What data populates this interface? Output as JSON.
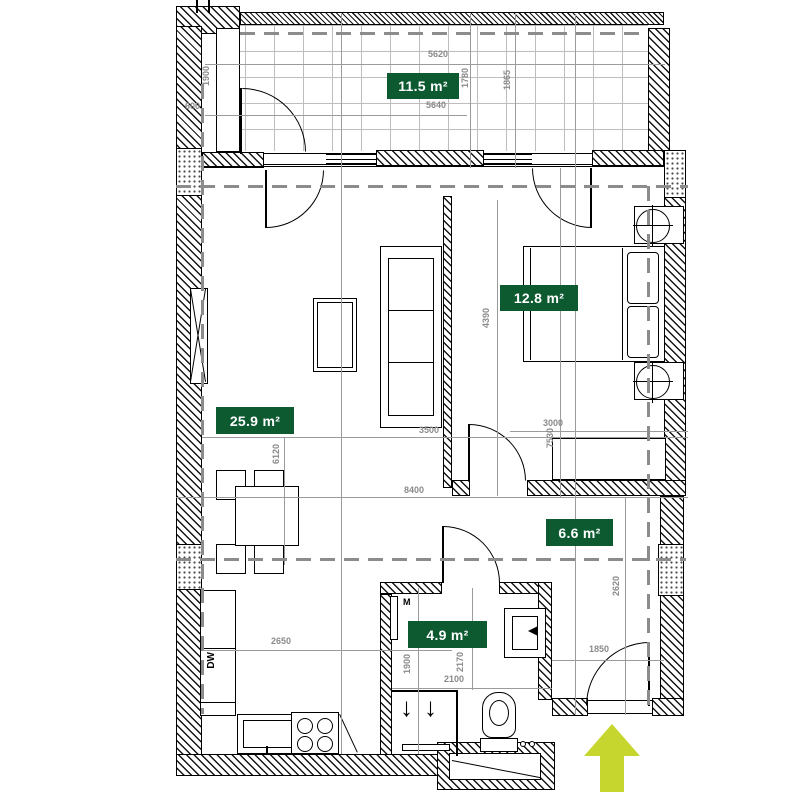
{
  "plan": {
    "rooms": [
      {
        "id": "balcony",
        "area_label": "11.5 m²"
      },
      {
        "id": "living_room",
        "area_label": "25.9 m²"
      },
      {
        "id": "bedroom",
        "area_label": "12.8 m²"
      },
      {
        "id": "hallway",
        "area_label": "6.6 m²"
      },
      {
        "id": "bathroom",
        "area_label": "4.9 m²"
      }
    ],
    "dimensions": {
      "balcony_width_top": "5620",
      "balcony_width_inner": "5640",
      "balcony_depth_left": "1780",
      "balcony_depth_right": "1865",
      "left_niche_depth": "1900",
      "left_wall": "600",
      "living_width": "3500",
      "living_length": "6120",
      "interior_length": "7530",
      "total_width": "8400",
      "bedroom_length": "4390",
      "bedroom_width": "3000",
      "hall_length": "2620",
      "entry_width": "1850",
      "kitchen_width": "2650",
      "bath_length": "1900",
      "bath_length_2": "2170",
      "bath_width": "2100"
    },
    "labels": {
      "dishwasher": "DW",
      "washer": "M"
    },
    "icons": {
      "shower_flow_down": "↓"
    },
    "colors": {
      "room_label_bg": "#0d5a31",
      "room_label_text": "#ffffff",
      "entrance_arrow": "#c6d62f",
      "dimension_text": "#8a8a8a"
    }
  }
}
